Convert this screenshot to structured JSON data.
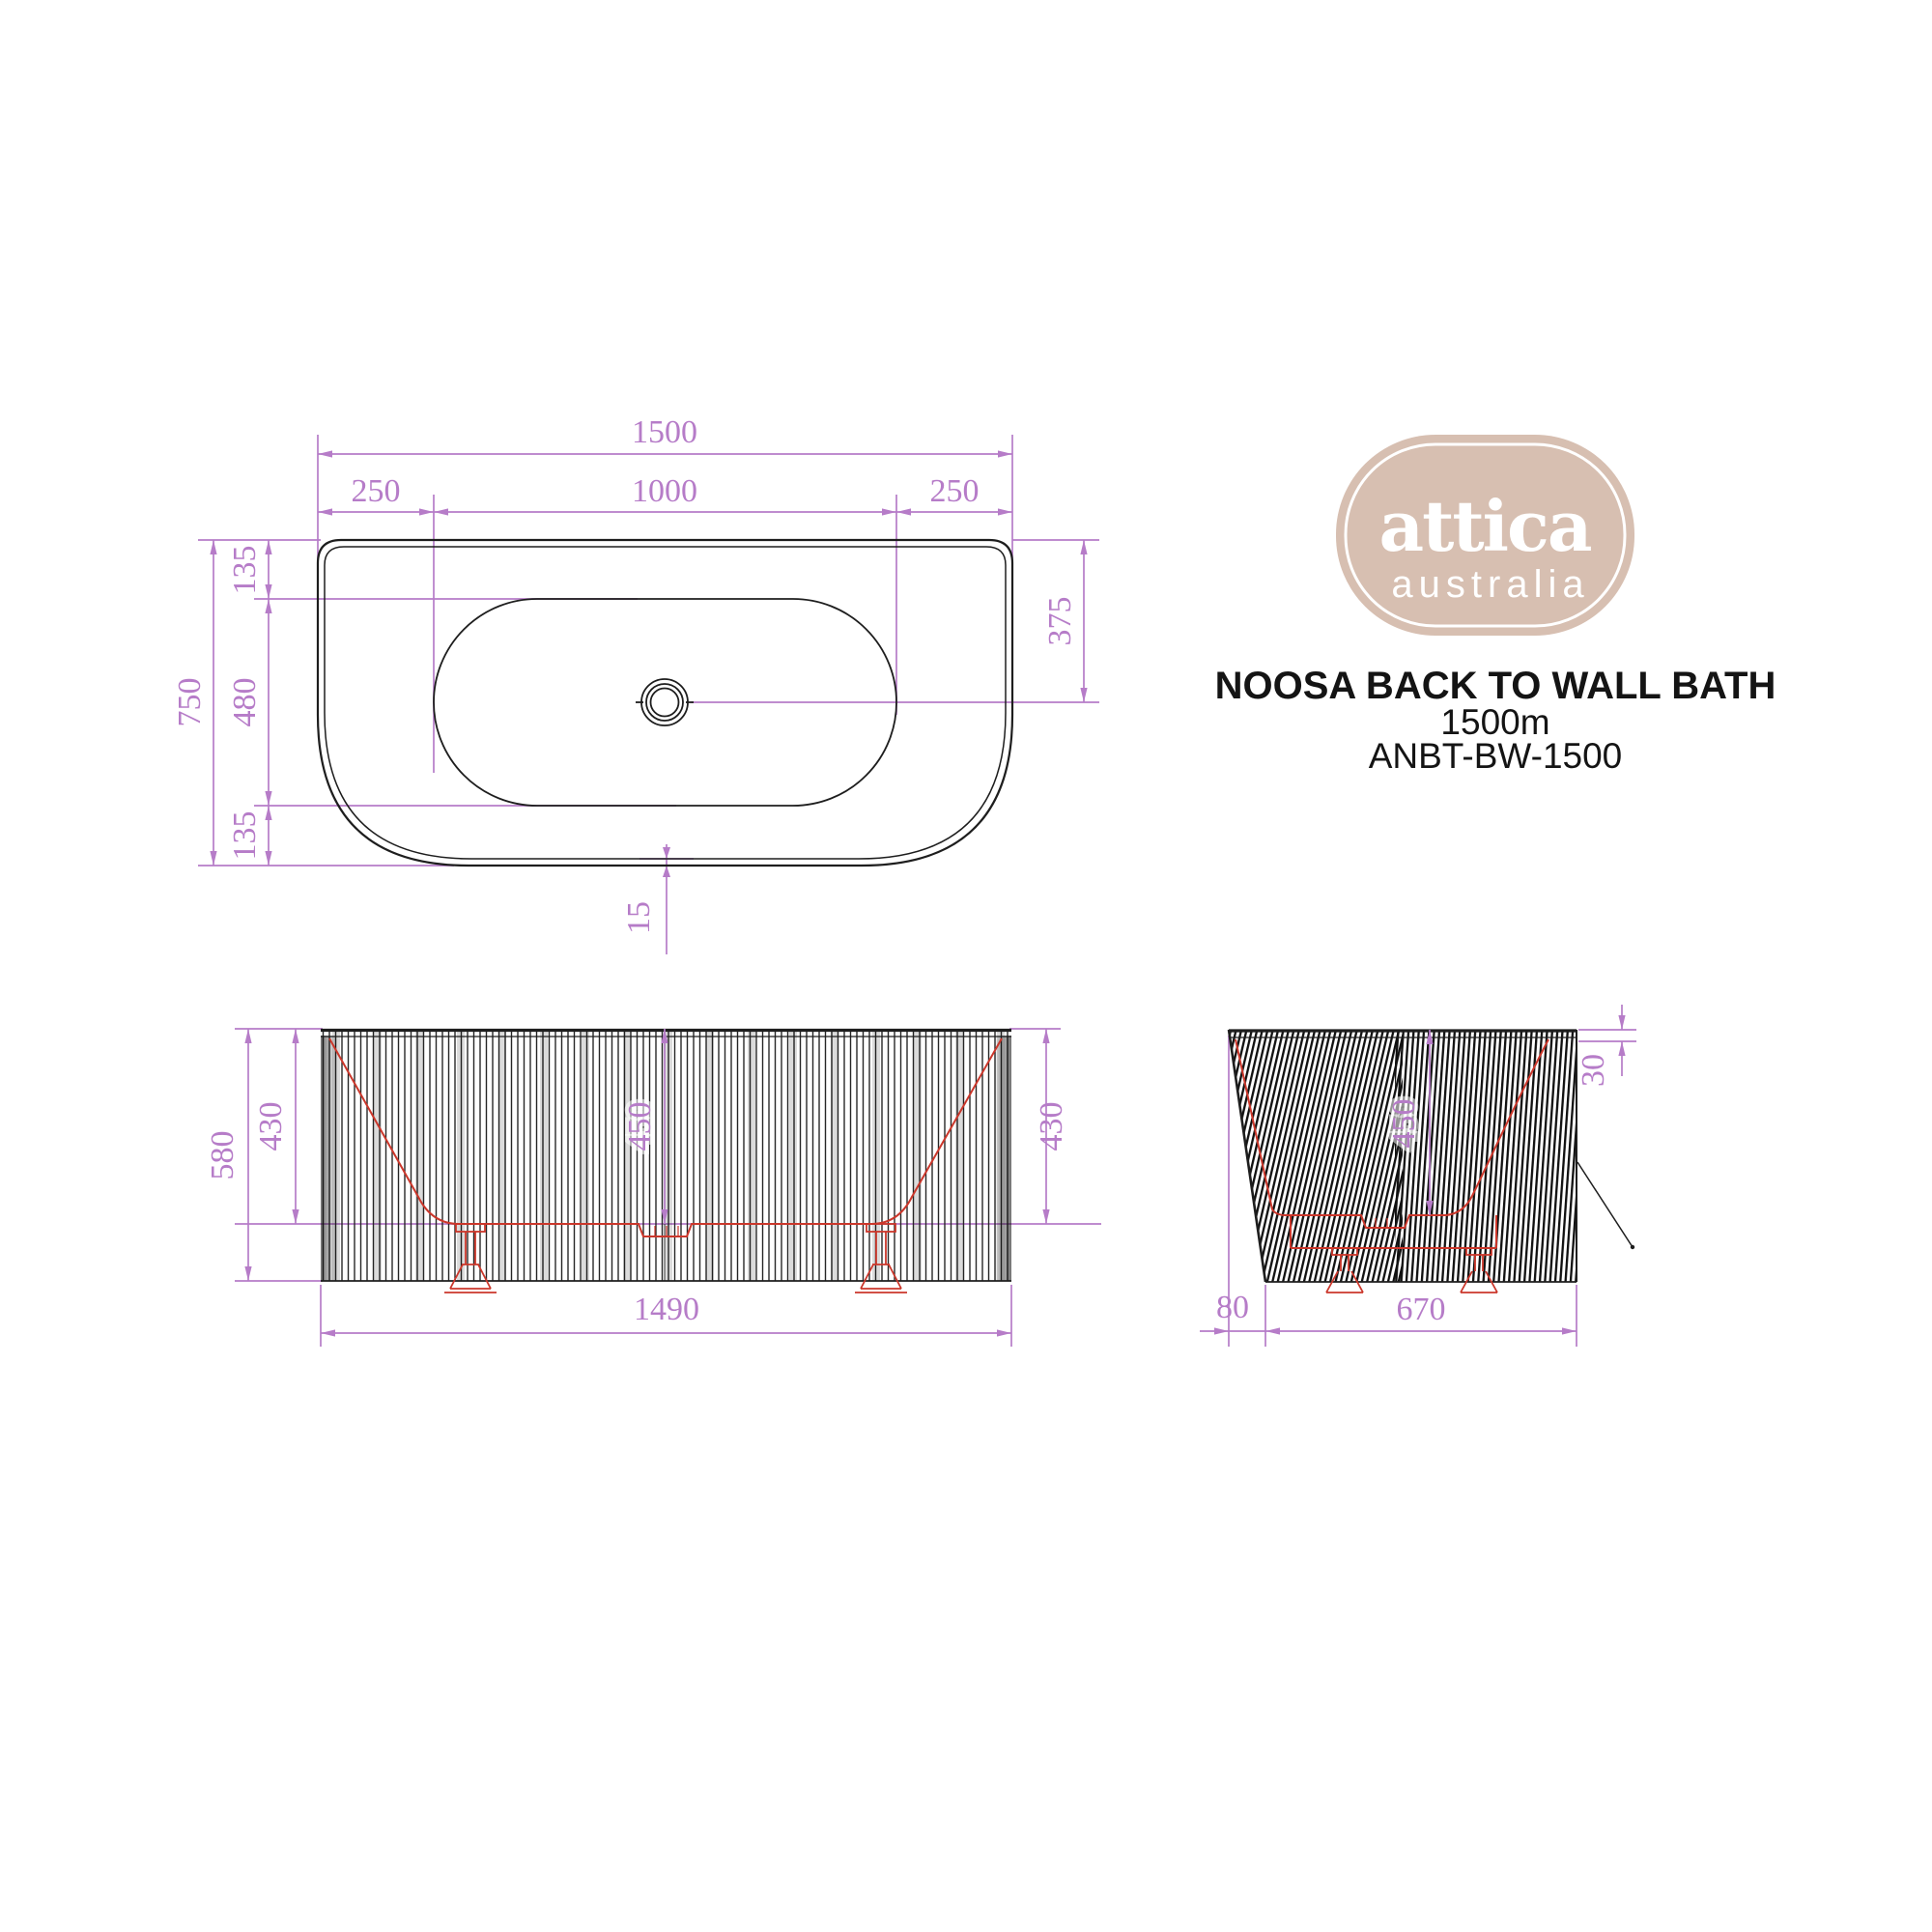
{
  "colors": {
    "dimension_purple": "#b67cc8",
    "profile_red": "#cb372b",
    "linework_black": "#1e1e1e",
    "logo_beige": "#d7bfb1",
    "background": "#ffffff"
  },
  "logo": {
    "name": "attica",
    "sub": "australia"
  },
  "product": {
    "title": "NOOSA BACK TO WALL BATH",
    "size": "1500m",
    "code": "ANBT-BW-1500"
  },
  "top_view": {
    "dims": {
      "overall_width": "1500",
      "edge_left": "250",
      "well_width": "1000",
      "edge_right": "250",
      "overall_depth": "750",
      "back_margin": "135",
      "well_length": "480",
      "front_margin": "135",
      "drain_offset": "375",
      "rim_thickness": "15"
    }
  },
  "front_view": {
    "dims": {
      "overall_height": "580",
      "inner_left": "430",
      "inner_center": "450",
      "inner_right": "430",
      "overall_width": "1490"
    }
  },
  "side_view": {
    "dims": {
      "lip_drop": "30",
      "inner_center": "450",
      "back_offset": "80",
      "base_width": "670"
    }
  }
}
